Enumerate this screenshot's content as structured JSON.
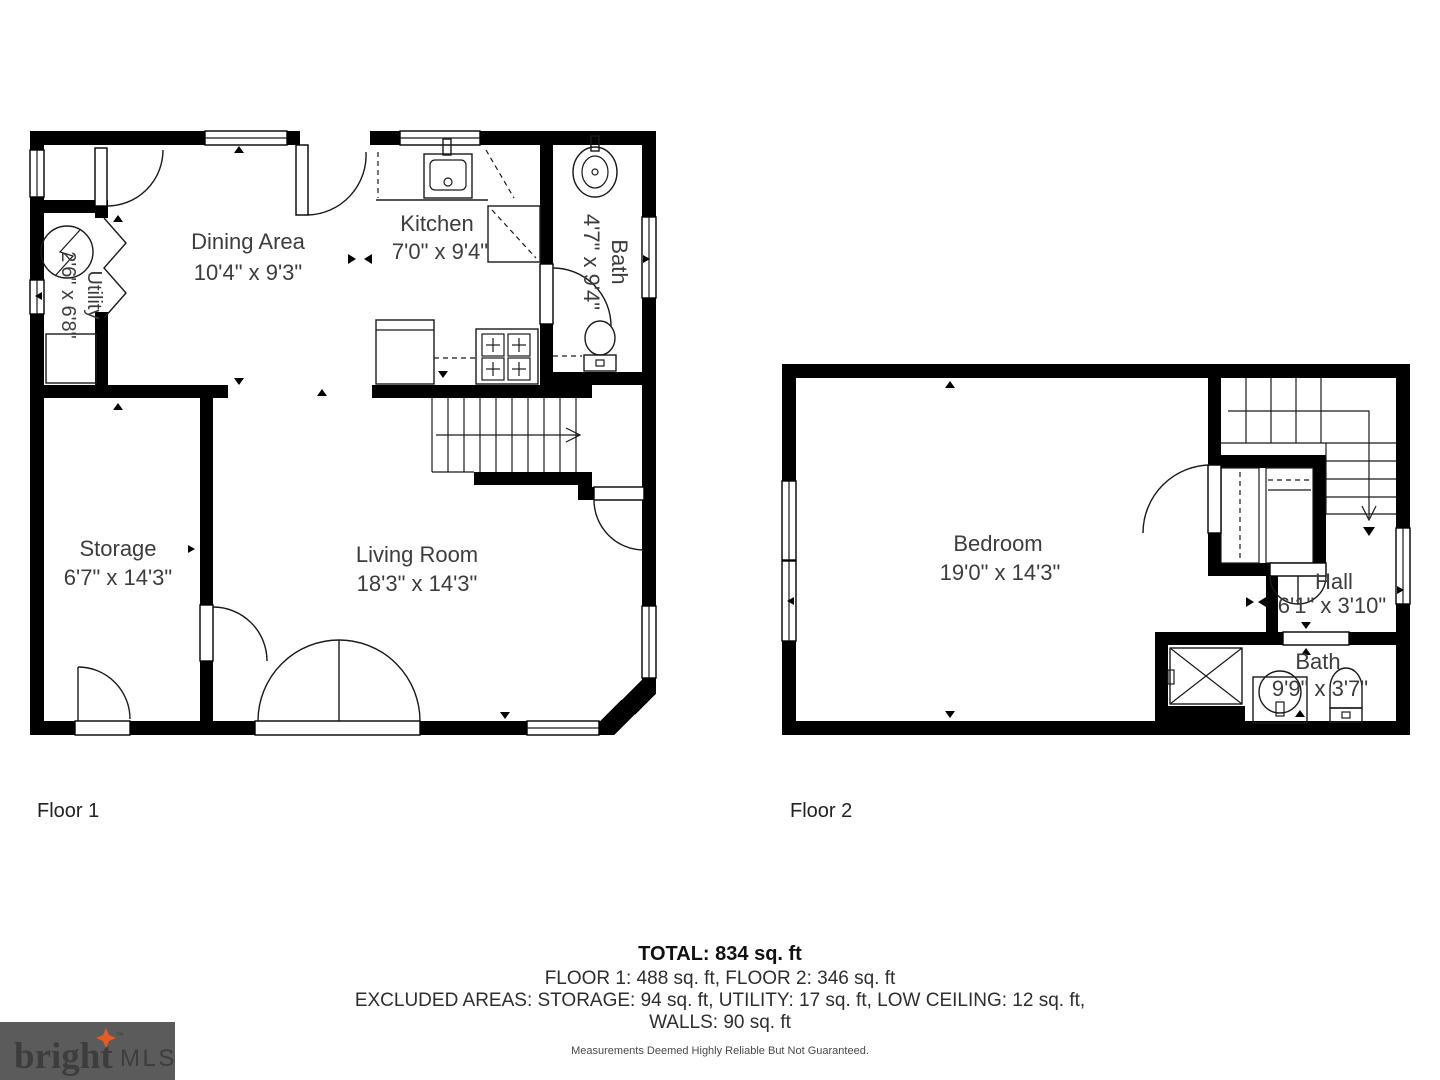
{
  "floor1": {
    "label": "Floor 1",
    "rooms": {
      "dining": {
        "name": "Dining Area",
        "dims": "10'4\" x 9'3\""
      },
      "kitchen": {
        "name": "Kitchen",
        "dims": "7'0\" x 9'4\""
      },
      "bath": {
        "name": "Bath",
        "dims": "4'7\" x 9'4\""
      },
      "utility": {
        "name": "Utility",
        "dims": "2'6\" x 6'8\""
      },
      "storage": {
        "name": "Storage",
        "dims": "6'7\" x 14'3\""
      },
      "living": {
        "name": "Living Room",
        "dims": "18'3\" x 14'3\""
      }
    }
  },
  "floor2": {
    "label": "Floor 2",
    "rooms": {
      "bedroom": {
        "name": "Bedroom",
        "dims": "19'0\" x 14'3\""
      },
      "hall": {
        "name": "Hall",
        "dims": "6'1\" x 3'10\""
      },
      "bath": {
        "name": "Bath",
        "dims": "9'9\" x 3'7\""
      }
    }
  },
  "summary": {
    "total": "TOTAL: 834 sq. ft",
    "floors": "FLOOR 1: 488 sq. ft, FLOOR 2: 346 sq. ft",
    "excluded": "EXCLUDED AREAS: STORAGE: 94 sq. ft, UTILITY: 17 sq. ft, LOW CEILING: 12 sq. ft,",
    "walls": "WALLS: 90 sq. ft"
  },
  "disclaimer": "Measurements Deemed Highly Reliable But Not Guaranteed.",
  "logo": {
    "brand": "bright",
    "tm": "™",
    "suffix": "MLS"
  },
  "colors": {
    "wall": "#000000",
    "label_text": "#3d3d3d",
    "logo_bg": "#5b5b5b",
    "logo_brand": "#f4f1ea",
    "logo_star": "#e85a24",
    "logo_mls": "#d6d4d0"
  }
}
